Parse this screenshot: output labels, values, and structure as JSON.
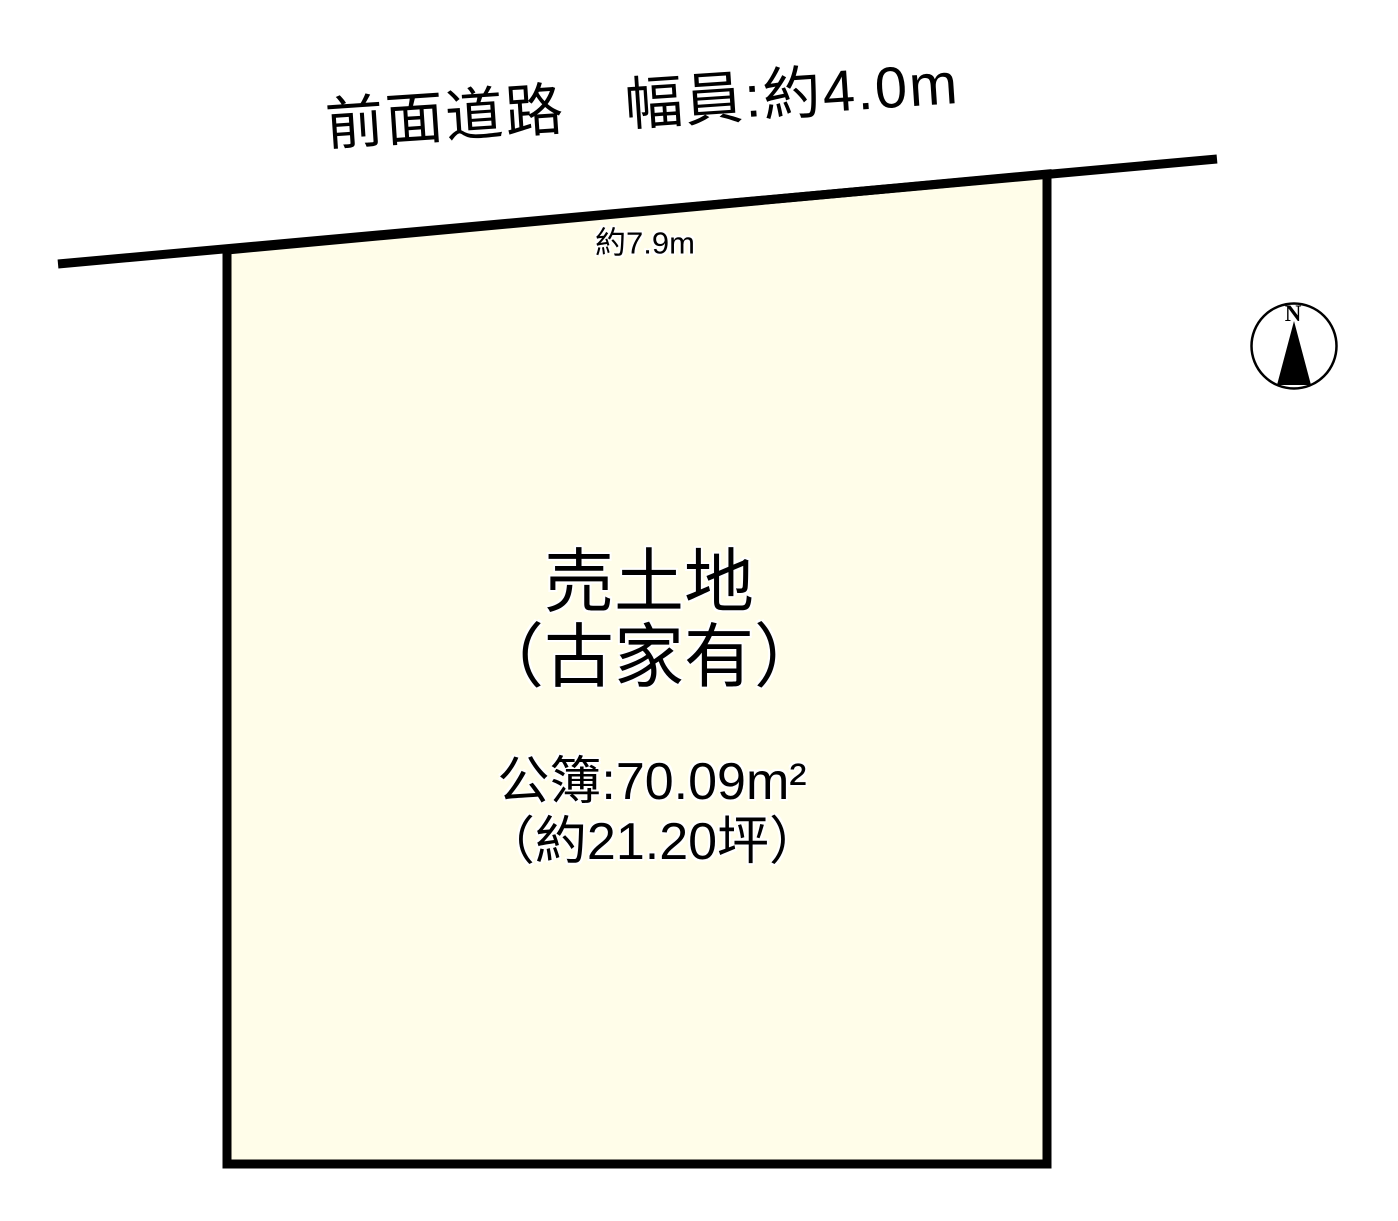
{
  "page": {
    "background_color": "#ffffff",
    "line_color": "#000000",
    "parcel_fill_color": "#fffde9"
  },
  "road": {
    "label": "前面道路　幅員:約4.0m"
  },
  "parcel": {
    "frontage_label": "約7.9m",
    "title_line1": "売土地",
    "title_line2": "（古家有）",
    "area_line1": "公簿:70.09m²",
    "area_line2": "（約21.20坪）"
  },
  "compass": {
    "north_label": "N"
  }
}
